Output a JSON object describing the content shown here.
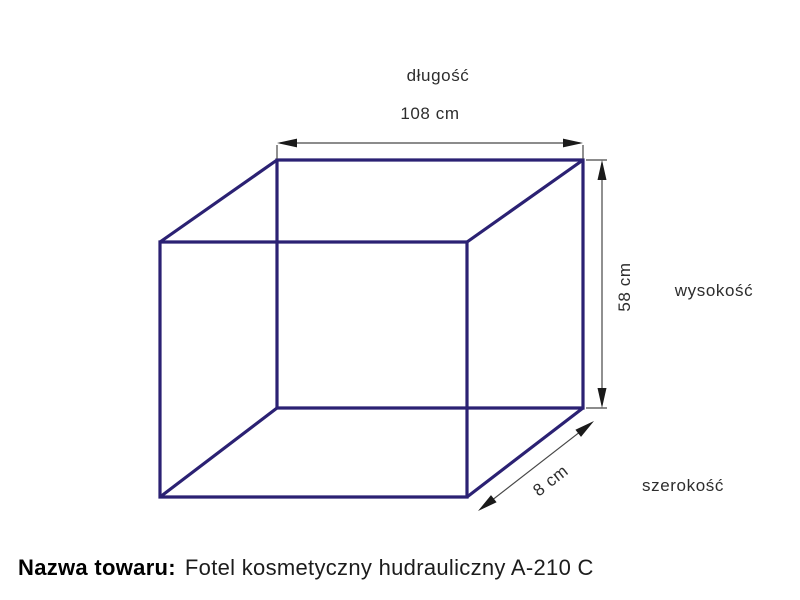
{
  "diagram": {
    "colors": {
      "box_line": "#2b2173",
      "dimension_line": "#474747",
      "arrowhead": "#1a1a1a"
    },
    "length": {
      "label": "długość",
      "value": "108 cm"
    },
    "height": {
      "label": "wysokość",
      "value": "58 cm"
    },
    "width": {
      "label": "szerokość",
      "value": "8 cm"
    }
  },
  "footer": {
    "label": "Nazwa towaru:",
    "product": "Fotel kosmetyczny hudrauliczny A-210 C"
  }
}
